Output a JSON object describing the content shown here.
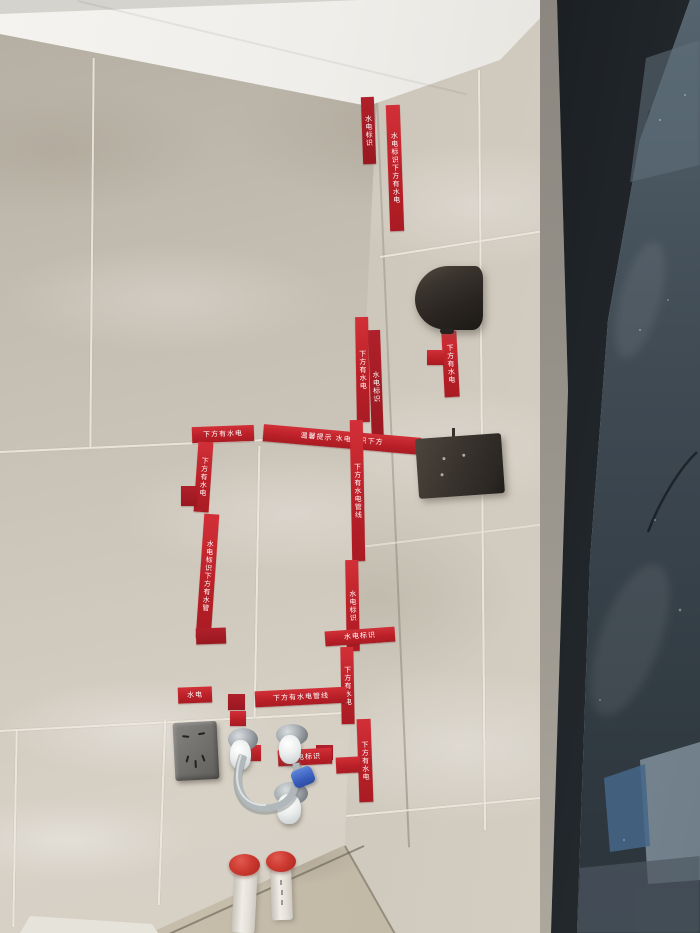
{
  "scene": {
    "description": "Bathroom corner under renovation: beige marble-look wall tiles marked with red water/electric warning tape, wall lamp, junction box cover, power outlet, capped water supply stubs with braided hose, two capped PVC floor pipes, and a black-framed dark glass door on the right.",
    "colors": {
      "tile_beige": "#cbc4b8",
      "tape_red": "#bb2028",
      "tape_text": "#ffffff",
      "ceiling_white": "#f2f0ec",
      "door_frame_black": "#15181b",
      "door_glass": "#3a444d",
      "plaster_gray": "#97928a",
      "floor_screed": "#c0b7a5",
      "pipe_cap_red": "#cc3a31",
      "pipe_white": "#eceae2",
      "hose_clip_blue": "#3a5fbe"
    }
  },
  "tape": {
    "warning_primary": "下方有水电管线",
    "warning_label": "水电标识",
    "warning_notice": "温馨提示",
    "segments": [
      {
        "x": 362,
        "y": 97,
        "w": 13,
        "h": 67,
        "rot": -2,
        "dir": "v",
        "text": "水电标识",
        "shade": "dark"
      },
      {
        "x": 388,
        "y": 105,
        "w": 14,
        "h": 126,
        "rot": -2,
        "dir": "v",
        "text": "水电标识下方有水电"
      },
      {
        "x": 356,
        "y": 317,
        "w": 13,
        "h": 105,
        "rot": -1,
        "dir": "v",
        "text": "下方有水电"
      },
      {
        "x": 370,
        "y": 330,
        "w": 12,
        "h": 113,
        "rot": -2,
        "dir": "v",
        "text": "水电标识",
        "shade": "dark"
      },
      {
        "x": 443,
        "y": 331,
        "w": 15,
        "h": 66,
        "rot": -3,
        "dir": "v",
        "text": "下方有水电"
      },
      {
        "x": 427,
        "y": 350,
        "w": 17,
        "h": 15,
        "rot": 0,
        "dir": "h",
        "text": ""
      },
      {
        "x": 263,
        "y": 431,
        "w": 158,
        "h": 17,
        "rot": 5,
        "dir": "h",
        "text": "温馨提示 水电标识下方"
      },
      {
        "x": 192,
        "y": 426,
        "w": 62,
        "h": 16,
        "rot": -2,
        "dir": "h",
        "text": "下方有水电"
      },
      {
        "x": 196,
        "y": 442,
        "w": 15,
        "h": 70,
        "rot": 4,
        "dir": "v",
        "text": "下方有水电"
      },
      {
        "x": 181,
        "y": 486,
        "w": 16,
        "h": 20,
        "rot": 0,
        "dir": "h",
        "text": "",
        "shade": "dark"
      },
      {
        "x": 200,
        "y": 514,
        "w": 15,
        "h": 124,
        "rot": 4,
        "dir": "v",
        "text": "水电标识下方有水管"
      },
      {
        "x": 196,
        "y": 628,
        "w": 30,
        "h": 16,
        "rot": -2,
        "dir": "h",
        "text": "",
        "shade": "dark"
      },
      {
        "x": 351,
        "y": 420,
        "w": 13,
        "h": 141,
        "rot": -1,
        "dir": "v",
        "text": "下方有水电管线"
      },
      {
        "x": 346,
        "y": 560,
        "w": 13,
        "h": 91,
        "rot": -1,
        "dir": "v",
        "text": "水电标识"
      },
      {
        "x": 325,
        "y": 629,
        "w": 70,
        "h": 15,
        "rot": -4,
        "dir": "h",
        "text": "水电标识"
      },
      {
        "x": 341,
        "y": 647,
        "w": 13,
        "h": 77,
        "rot": -1,
        "dir": "v",
        "text": "下方有水电"
      },
      {
        "x": 255,
        "y": 689,
        "w": 92,
        "h": 16,
        "rot": -3,
        "dir": "h",
        "text": "下方有水电管线"
      },
      {
        "x": 228,
        "y": 694,
        "w": 17,
        "h": 16,
        "rot": 0,
        "dir": "h",
        "text": "",
        "shade": "dark"
      },
      {
        "x": 230,
        "y": 711,
        "w": 16,
        "h": 15,
        "rot": 0,
        "dir": "h",
        "text": ""
      },
      {
        "x": 178,
        "y": 687,
        "w": 34,
        "h": 16,
        "rot": -2,
        "dir": "h",
        "text": "水电"
      },
      {
        "x": 358,
        "y": 719,
        "w": 14,
        "h": 83,
        "rot": -2,
        "dir": "v",
        "text": "下方有水电"
      },
      {
        "x": 336,
        "y": 757,
        "w": 24,
        "h": 16,
        "rot": -3,
        "dir": "h",
        "text": ""
      },
      {
        "x": 316,
        "y": 745,
        "w": 17,
        "h": 15,
        "rot": 0,
        "dir": "h",
        "text": "",
        "shade": "dark"
      },
      {
        "x": 278,
        "y": 749,
        "w": 54,
        "h": 16,
        "rot": -3,
        "dir": "h",
        "text": "水电标识"
      },
      {
        "x": 247,
        "y": 745,
        "w": 14,
        "h": 16,
        "rot": 0,
        "dir": "h",
        "text": ""
      }
    ]
  }
}
